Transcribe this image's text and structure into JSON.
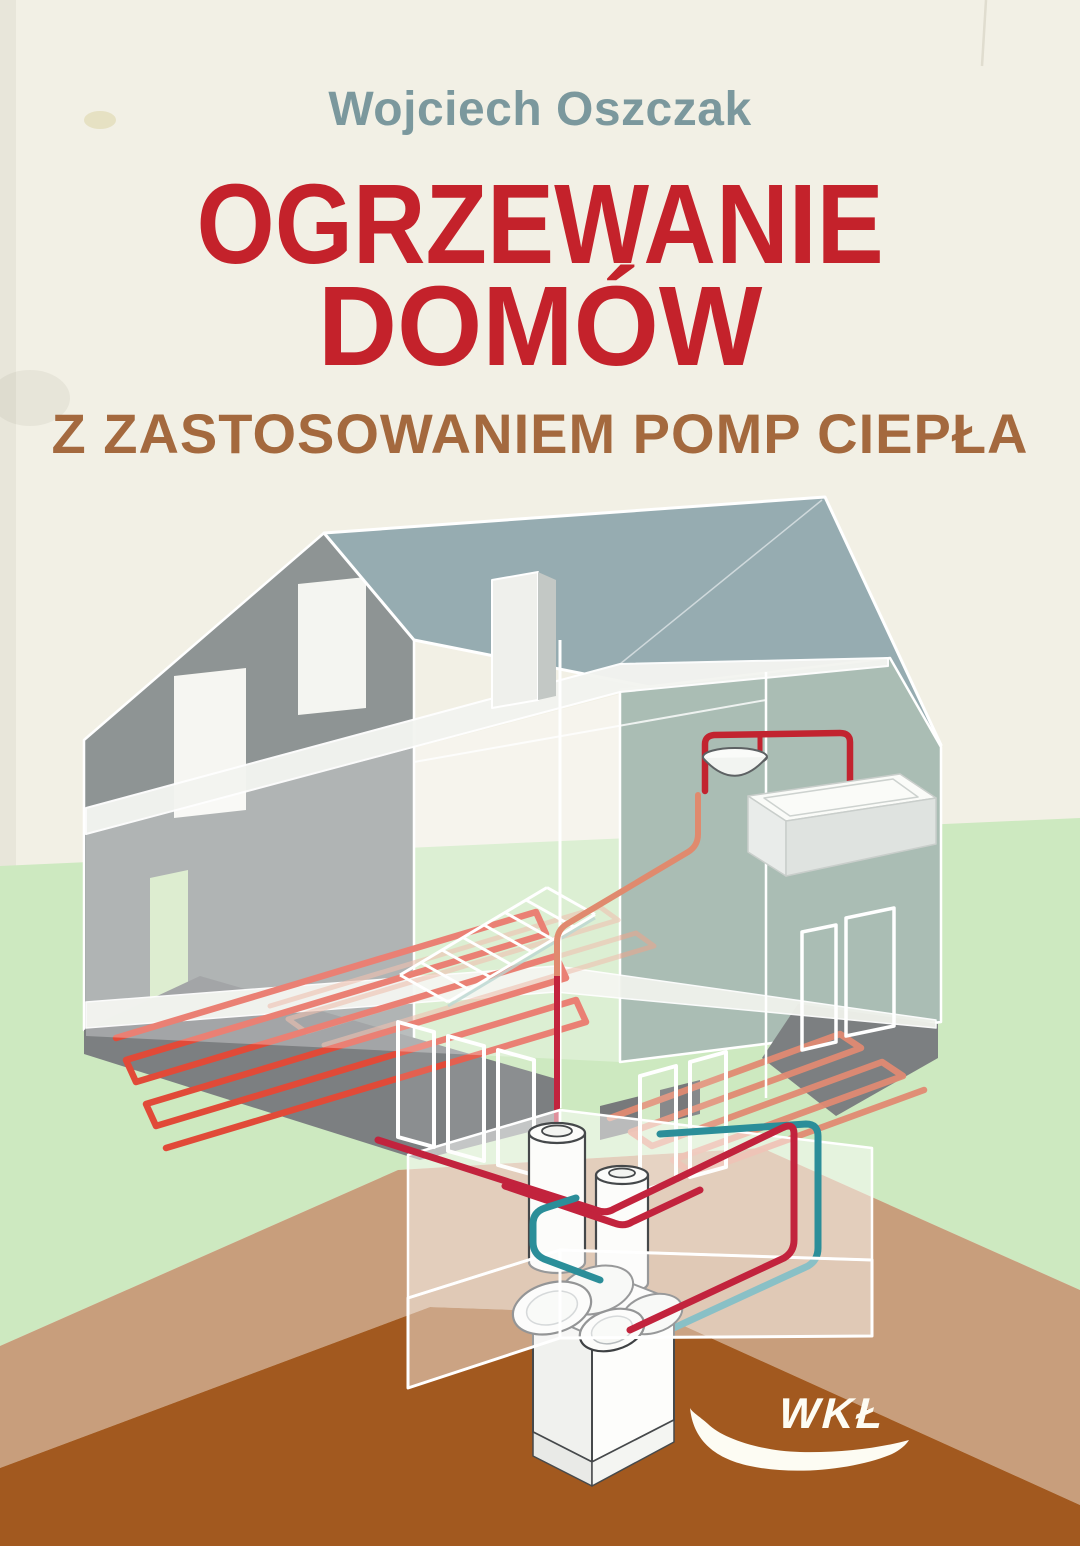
{
  "cover": {
    "author": "Wojciech Oszczak",
    "title": {
      "line1": "OGRZEWANIE",
      "line2": "DOMÓW"
    },
    "subtitle": "Z ZASTOSOWANIEM POMP CIEPŁA",
    "publisher": {
      "logo_text": "WKŁ"
    },
    "colors": {
      "author_teal": "#7b989d",
      "title_red": "#c4222b",
      "subtitle_brown": "#a4693e",
      "background_cream": "#f2f0e5",
      "grass_green": "#cde9c0",
      "soil_tan": "#c89e7c",
      "soil_brown": "#a2591f",
      "roof_blue_gray": "#96acb1",
      "gable_wall_gray": "#8e9494",
      "right_wall_green_gray": "#aabdb4",
      "underfloor_coil_red": "#e14a38",
      "underfloor_coil_salmon": "#e08a72",
      "supply_pipe_crimson": "#c2233d",
      "return_pipe_teal": "#2b8e99",
      "logo_white": "#fdfcf3"
    },
    "illustration_alt": "Cutaway isometric house with underfloor heating loops, storage tanks and a heat pump in the basement"
  }
}
